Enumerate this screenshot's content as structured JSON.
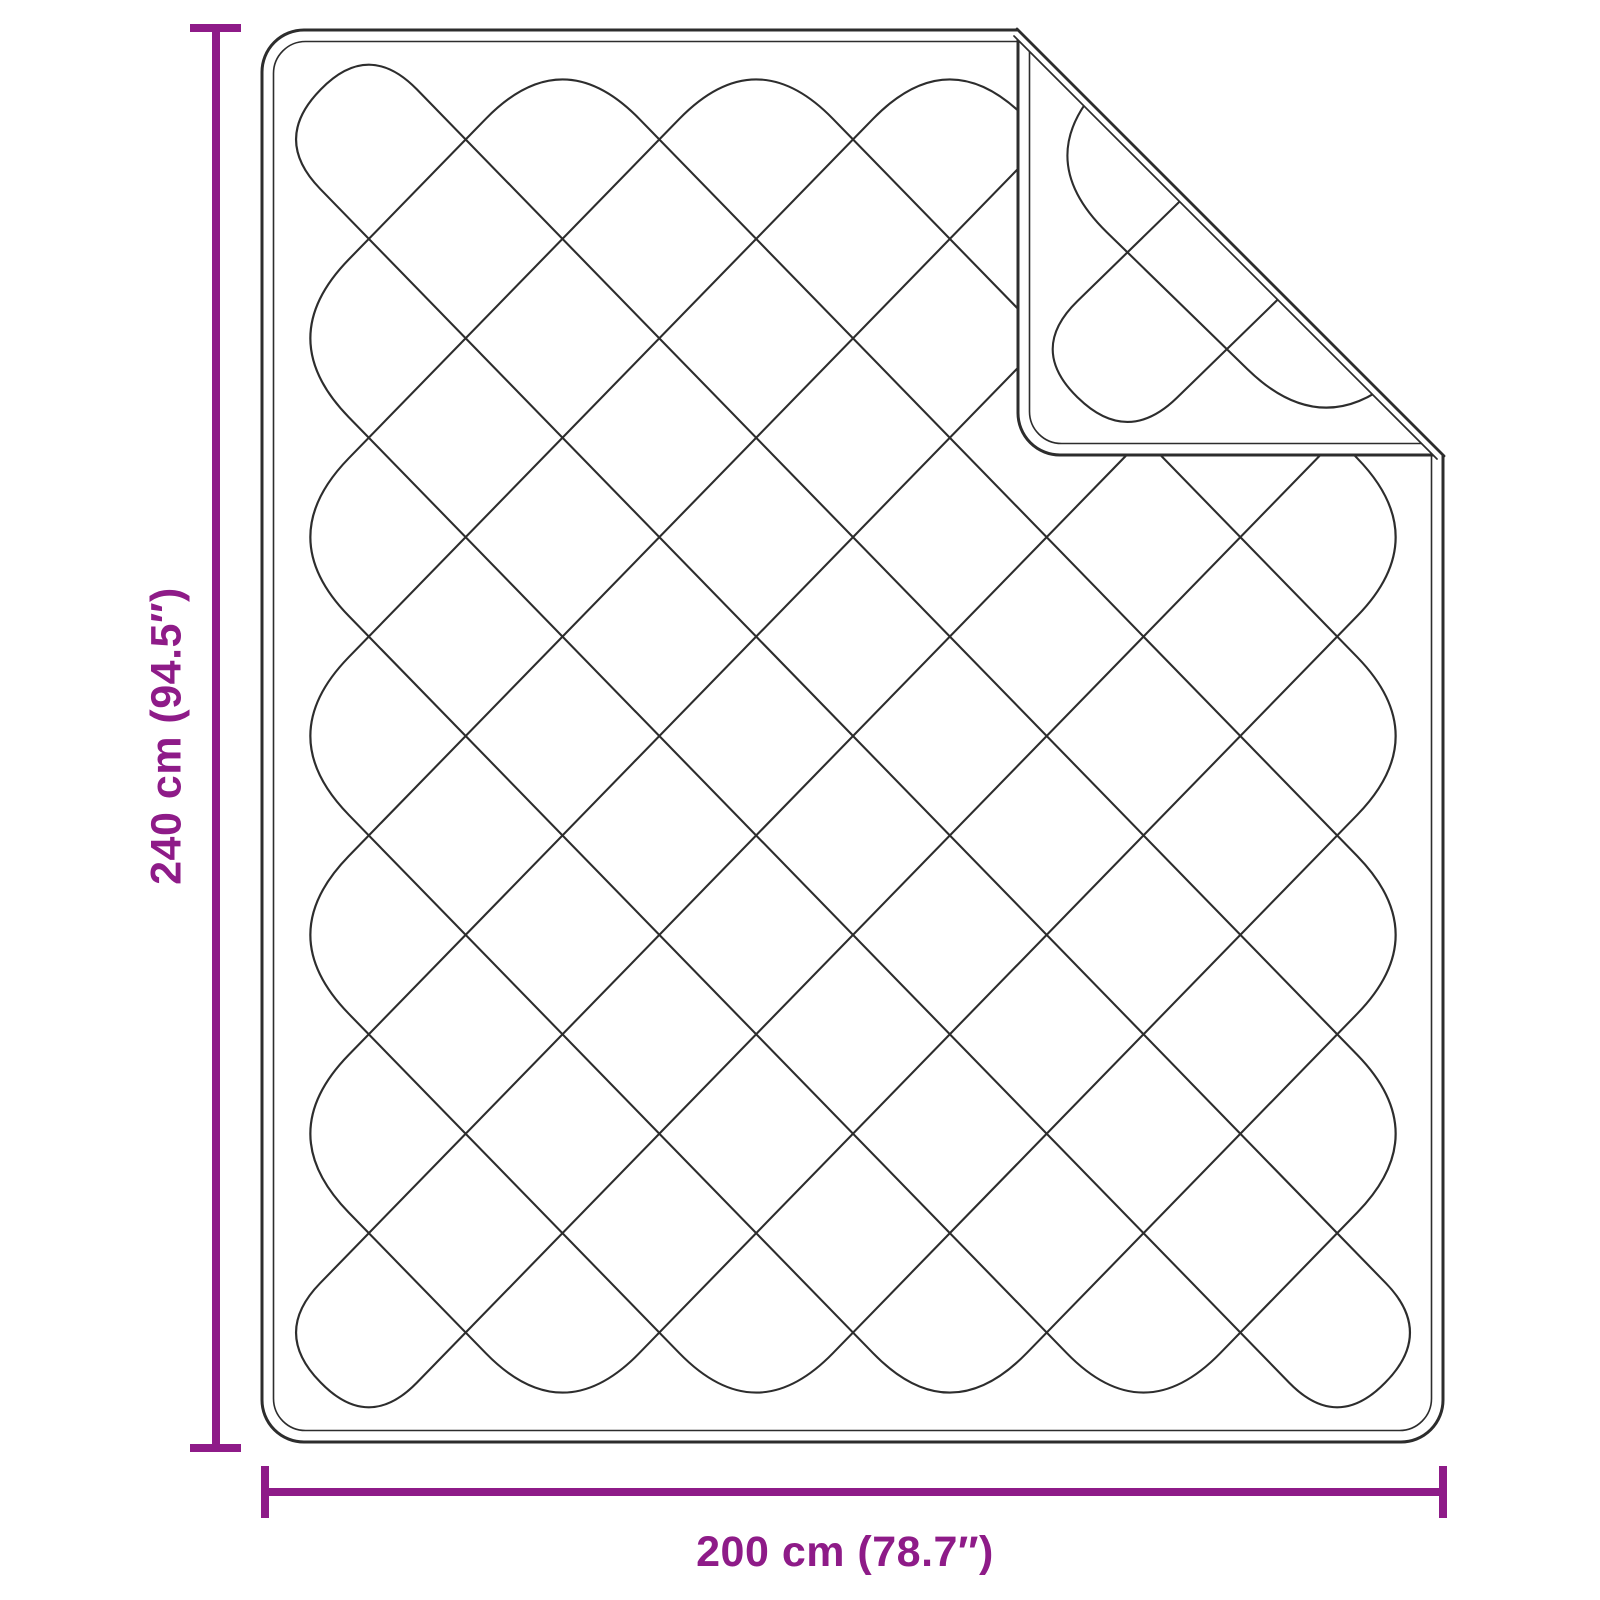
{
  "colors": {
    "accent": "#8E1B88",
    "line": "#2D2D2D",
    "background": "#FFFFFF"
  },
  "diagram": {
    "object": "quilted blanket top view with folded corner",
    "dimensions": {
      "height": {
        "label": "240 cm (94.5″)"
      },
      "width": {
        "label": "200 cm (78.7″)"
      }
    }
  }
}
